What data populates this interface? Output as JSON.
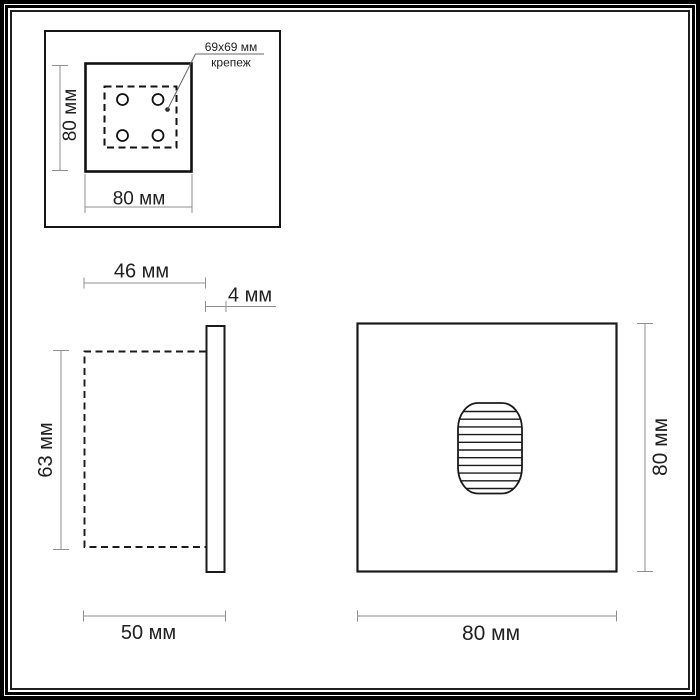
{
  "colors": {
    "drawing_line": "#1a1a1a",
    "dimension_line": "#8f8f8f",
    "leader_line": "#666666",
    "background": "#ffffff",
    "frame_border": "#000000"
  },
  "mounting_view": {
    "width": "80 мм",
    "height": "80 мм",
    "anno_line1": "69x69 мм",
    "anno_line2": "крепеж"
  },
  "side_view": {
    "recess_depth": "46 мм",
    "faceplate_thickness": "4 мм",
    "body_height": "63 мм",
    "total_depth": "50 мм"
  },
  "front_view": {
    "width": "80 мм",
    "height": "80 мм"
  }
}
